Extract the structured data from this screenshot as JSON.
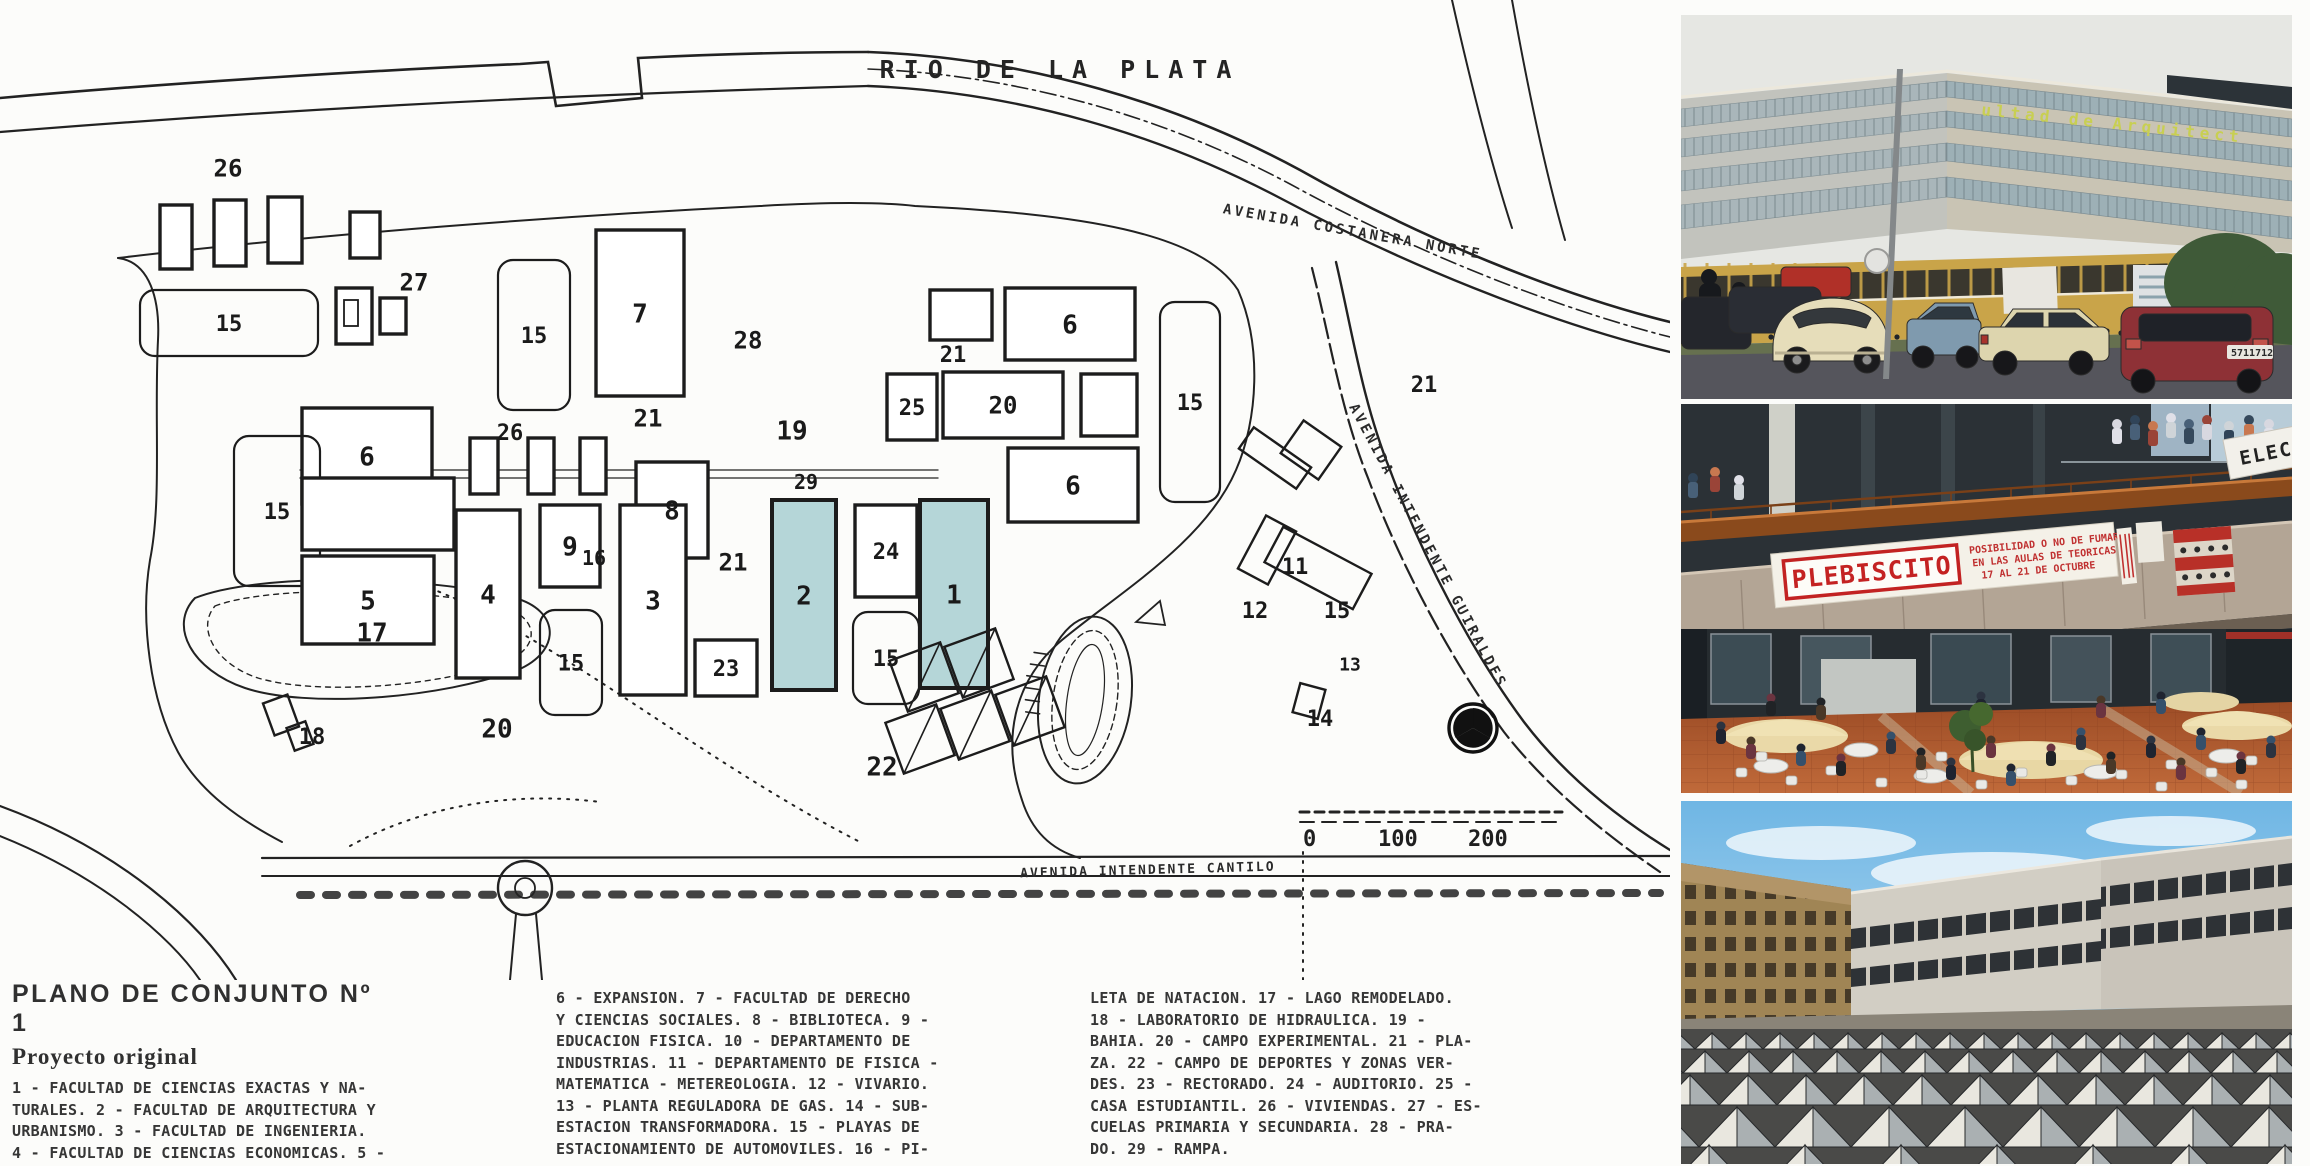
{
  "map": {
    "river_label": "RIO DE LA PLATA",
    "highlight_color": "#b5d6d8",
    "ink_color": "#1c1c1c",
    "road_labels": [
      {
        "text": "AVENIDA COSTANERA NORTE",
        "x": 1352,
        "y": 236,
        "rotate": 10,
        "size": 14,
        "spacing": 3
      },
      {
        "text": "AVENIDA INTENDENTE GUIRALDES",
        "x": 1424,
        "y": 548,
        "rotate": 62,
        "size": 14,
        "spacing": 3
      },
      {
        "text": "AVENIDA INTENDENTE CANTILO",
        "x": 1148,
        "y": 874,
        "rotate": -1.5,
        "size": 13,
        "spacing": 2
      }
    ],
    "scale_bar": {
      "labels": [
        "0",
        "100",
        "200"
      ],
      "xs": [
        1303,
        1378,
        1468
      ],
      "y": 846
    },
    "buildings": [
      {
        "l": "26",
        "x": 228,
        "y": 168,
        "t": "n",
        "fs": 24
      },
      {
        "l": "",
        "x": 160,
        "y": 205,
        "w": 32,
        "h": 64,
        "t": "r"
      },
      {
        "l": "",
        "x": 214,
        "y": 200,
        "w": 32,
        "h": 66,
        "t": "r"
      },
      {
        "l": "",
        "x": 268,
        "y": 197,
        "w": 34,
        "h": 66,
        "t": "r"
      },
      {
        "l": "",
        "x": 350,
        "y": 212,
        "w": 30,
        "h": 46,
        "t": "r"
      },
      {
        "l": "",
        "x": 336,
        "y": 288,
        "w": 36,
        "h": 56,
        "t": "r"
      },
      {
        "l": "",
        "x": 344,
        "y": 300,
        "w": 14,
        "h": 26,
        "t": "r2"
      },
      {
        "l": "",
        "x": 380,
        "y": 298,
        "w": 26,
        "h": 36,
        "t": "r"
      },
      {
        "l": "27",
        "x": 414,
        "y": 282,
        "t": "n",
        "fs": 24
      },
      {
        "l": "15",
        "x": 140,
        "y": 290,
        "w": 178,
        "h": 66,
        "t": "p"
      },
      {
        "l": "15",
        "x": 498,
        "y": 260,
        "w": 72,
        "h": 150,
        "t": "p"
      },
      {
        "l": "7",
        "x": 596,
        "y": 230,
        "w": 88,
        "h": 166,
        "t": "r",
        "fs": 26
      },
      {
        "l": "28",
        "x": 748,
        "y": 340,
        "t": "n",
        "fs": 24
      },
      {
        "l": "19",
        "x": 792,
        "y": 430,
        "t": "n",
        "fs": 26
      },
      {
        "l": "6",
        "x": 302,
        "y": 408,
        "w": 130,
        "h": 96,
        "t": "r",
        "fs": 26
      },
      {
        "l": "26",
        "x": 510,
        "y": 432,
        "t": "n",
        "fs": 22
      },
      {
        "l": "",
        "x": 470,
        "y": 438,
        "w": 28,
        "h": 56,
        "t": "r"
      },
      {
        "l": "",
        "x": 528,
        "y": 438,
        "w": 26,
        "h": 56,
        "t": "r"
      },
      {
        "l": "",
        "x": 580,
        "y": 438,
        "w": 26,
        "h": 56,
        "t": "r"
      },
      {
        "l": "21",
        "x": 648,
        "y": 418,
        "t": "n",
        "fs": 24
      },
      {
        "l": "8",
        "x": 636,
        "y": 462,
        "w": 72,
        "h": 96,
        "t": "r",
        "fs": 26
      },
      {
        "l": "",
        "x": 557,
        "y": 528,
        "w": 22,
        "h": 40,
        "t": "r"
      },
      {
        "l": "16",
        "x": 594,
        "y": 558,
        "t": "n",
        "fs": 20
      },
      {
        "l": "29",
        "x": 806,
        "y": 482,
        "t": "n",
        "fs": 20
      },
      {
        "l": "15",
        "x": 234,
        "y": 436,
        "w": 86,
        "h": 150,
        "t": "p"
      },
      {
        "l": "",
        "x": 302,
        "y": 478,
        "w": 152,
        "h": 72,
        "t": "r"
      },
      {
        "l": "5",
        "x": 302,
        "y": 556,
        "w": 132,
        "h": 88,
        "t": "r",
        "fs": 26
      },
      {
        "l": "4",
        "x": 456,
        "y": 510,
        "w": 64,
        "h": 168,
        "t": "r",
        "fs": 26
      },
      {
        "l": "9",
        "x": 540,
        "y": 505,
        "w": 60,
        "h": 82,
        "t": "r",
        "fs": 26
      },
      {
        "l": "15",
        "x": 540,
        "y": 610,
        "w": 62,
        "h": 105,
        "t": "p"
      },
      {
        "l": "3",
        "x": 620,
        "y": 505,
        "w": 66,
        "h": 190,
        "t": "r",
        "fs": 26
      },
      {
        "l": "21",
        "x": 733,
        "y": 562,
        "t": "n",
        "fs": 24
      },
      {
        "l": "23",
        "x": 695,
        "y": 640,
        "w": 62,
        "h": 56,
        "t": "r",
        "fs": 22
      },
      {
        "l": "2",
        "x": 772,
        "y": 500,
        "w": 64,
        "h": 190,
        "t": "h",
        "fs": 26
      },
      {
        "l": "24",
        "x": 855,
        "y": 505,
        "w": 62,
        "h": 92,
        "t": "r",
        "fs": 22
      },
      {
        "l": "15",
        "x": 853,
        "y": 612,
        "w": 66,
        "h": 92,
        "t": "p"
      },
      {
        "l": "1",
        "x": 920,
        "y": 500,
        "w": 68,
        "h": 188,
        "t": "h",
        "fs": 26
      },
      {
        "l": "25",
        "x": 887,
        "y": 374,
        "w": 50,
        "h": 66,
        "t": "r",
        "fs": 22
      },
      {
        "l": "20",
        "x": 943,
        "y": 372,
        "w": 120,
        "h": 66,
        "t": "r",
        "fs": 24
      },
      {
        "l": "",
        "x": 930,
        "y": 290,
        "w": 62,
        "h": 50,
        "t": "r"
      },
      {
        "l": "21",
        "x": 953,
        "y": 354,
        "t": "n",
        "fs": 22
      },
      {
        "l": "6",
        "x": 1005,
        "y": 288,
        "w": 130,
        "h": 72,
        "t": "r",
        "fs": 26
      },
      {
        "l": "",
        "x": 1081,
        "y": 374,
        "w": 56,
        "h": 62,
        "t": "r"
      },
      {
        "l": "15",
        "x": 1160,
        "y": 302,
        "w": 60,
        "h": 200,
        "t": "p"
      },
      {
        "l": "6",
        "x": 1008,
        "y": 448,
        "w": 130,
        "h": 74,
        "t": "r",
        "fs": 26
      },
      {
        "l": "21",
        "x": 1424,
        "y": 384,
        "t": "n",
        "fs": 22
      },
      {
        "l": "",
        "x": 1240,
        "y": 445,
        "w": 70,
        "h": 26,
        "t": "a",
        "rot": 35
      },
      {
        "l": "",
        "x": 1288,
        "y": 430,
        "w": 46,
        "h": 40,
        "t": "a",
        "rot": 35
      },
      {
        "l": "",
        "x": 1250,
        "y": 520,
        "w": 34,
        "h": 60,
        "t": "a",
        "rot": 28
      },
      {
        "l": "",
        "x": 1268,
        "y": 548,
        "w": 100,
        "h": 40,
        "t": "a",
        "rot": 28
      },
      {
        "l": "11",
        "x": 1295,
        "y": 566,
        "t": "n",
        "fs": 22
      },
      {
        "l": "12",
        "x": 1255,
        "y": 610,
        "t": "n",
        "fs": 22
      },
      {
        "l": "15",
        "x": 1337,
        "y": 610,
        "t": "n",
        "fs": 22
      },
      {
        "l": "13",
        "x": 1350,
        "y": 664,
        "t": "n",
        "fs": 18
      },
      {
        "l": "",
        "x": 1296,
        "y": 686,
        "w": 26,
        "h": 30,
        "t": "a",
        "rot": 15
      },
      {
        "l": "14",
        "x": 1320,
        "y": 718,
        "t": "n",
        "fs": 22
      },
      {
        "l": "17",
        "x": 372,
        "y": 632,
        "t": "n",
        "fs": 26
      },
      {
        "l": "",
        "x": 268,
        "y": 698,
        "w": 26,
        "h": 34,
        "t": "a",
        "rot": -20
      },
      {
        "l": "",
        "x": 290,
        "y": 724,
        "w": 20,
        "h": 24,
        "t": "a",
        "rot": -20
      },
      {
        "l": "18",
        "x": 312,
        "y": 736,
        "t": "n",
        "fs": 22
      },
      {
        "l": "20",
        "x": 497,
        "y": 728,
        "t": "n",
        "fs": 26
      },
      {
        "l": "22",
        "x": 882,
        "y": 766,
        "t": "n",
        "fs": 26
      },
      {
        "l": "",
        "x": 897,
        "y": 650,
        "w": 54,
        "h": 54,
        "t": "a",
        "rot": -20,
        "diag": true
      },
      {
        "l": "",
        "x": 952,
        "y": 636,
        "w": 54,
        "h": 54,
        "t": "a",
        "rot": -20,
        "diag": true
      },
      {
        "l": "",
        "x": 893,
        "y": 712,
        "w": 54,
        "h": 54,
        "t": "a",
        "rot": -20,
        "diag": true
      },
      {
        "l": "",
        "x": 948,
        "y": 698,
        "w": 54,
        "h": 54,
        "t": "a",
        "rot": -20,
        "diag": true
      },
      {
        "l": "",
        "x": 1003,
        "y": 684,
        "w": 54,
        "h": 54,
        "t": "a",
        "rot": -20,
        "diag": true
      }
    ]
  },
  "legend": {
    "title": "PLANO DE CONJUNTO Nº 1",
    "subtitle": "Proyecto original",
    "columns": [
      [
        "1 - FACULTAD DE CIENCIAS EXACTAS Y NA-",
        "TURALES. 2 - FACULTAD DE ARQUITECTURA Y",
        "URBANISMO. 3 - FACULTAD DE INGENIERIA.",
        "4 - FACULTAD DE CIENCIAS ECONOMICAS. 5 -",
        "FACULTAD DE AGRONOMIA Y VETERINARIA."
      ],
      [
        "6 - EXPANSION. 7 - FACULTAD DE DERECHO",
        "Y CIENCIAS SOCIALES. 8 - BIBLIOTECA. 9 -",
        "EDUCACION FISICA. 10 - DEPARTAMENTO DE",
        "INDUSTRIAS. 11 - DEPARTAMENTO DE FISICA -",
        "MATEMATICA - METEREOLOGIA. 12 - VIVARIO.",
        "13 - PLANTA REGULADORA DE GAS. 14 - SUB-",
        "ESTACION TRANSFORMADORA. 15 - PLAYAS DE",
        "ESTACIONAMIENTO DE AUTOMOVILES. 16 - PI-"
      ],
      [
        "LETA DE NATACION. 17 - LAGO REMODELADO.",
        "18 - LABORATORIO DE HIDRAULICA. 19 -",
        "BAHIA. 20 - CAMPO EXPERIMENTAL. 21 - PLA-",
        "ZA. 22 - CAMPO DE DEPORTES Y ZONAS VER-",
        "DES. 23 - RECTORADO. 24 - AUDITORIO. 25 -",
        "CASA ESTUDIANTIL. 26 - VIVIENDAS. 27 - ES-",
        "CUELAS PRIMARIA Y SECUNDARIA. 28 - PRA-",
        "DO. 29 - RAMPA."
      ]
    ]
  },
  "photos": {
    "facade": {
      "sign": "ultad de Arquitect",
      "plate": "5711712"
    },
    "plaza": {
      "banner_title": "PLEBISCITO",
      "banner_line1": "POSIBILIDAD O NO DE FUMAR",
      "banner_line2": "EN LAS AULAS DE TEORICAS",
      "banner_line3": "17 AL 21 DE OCTUBRE",
      "side_banner": "ELECC"
    }
  }
}
